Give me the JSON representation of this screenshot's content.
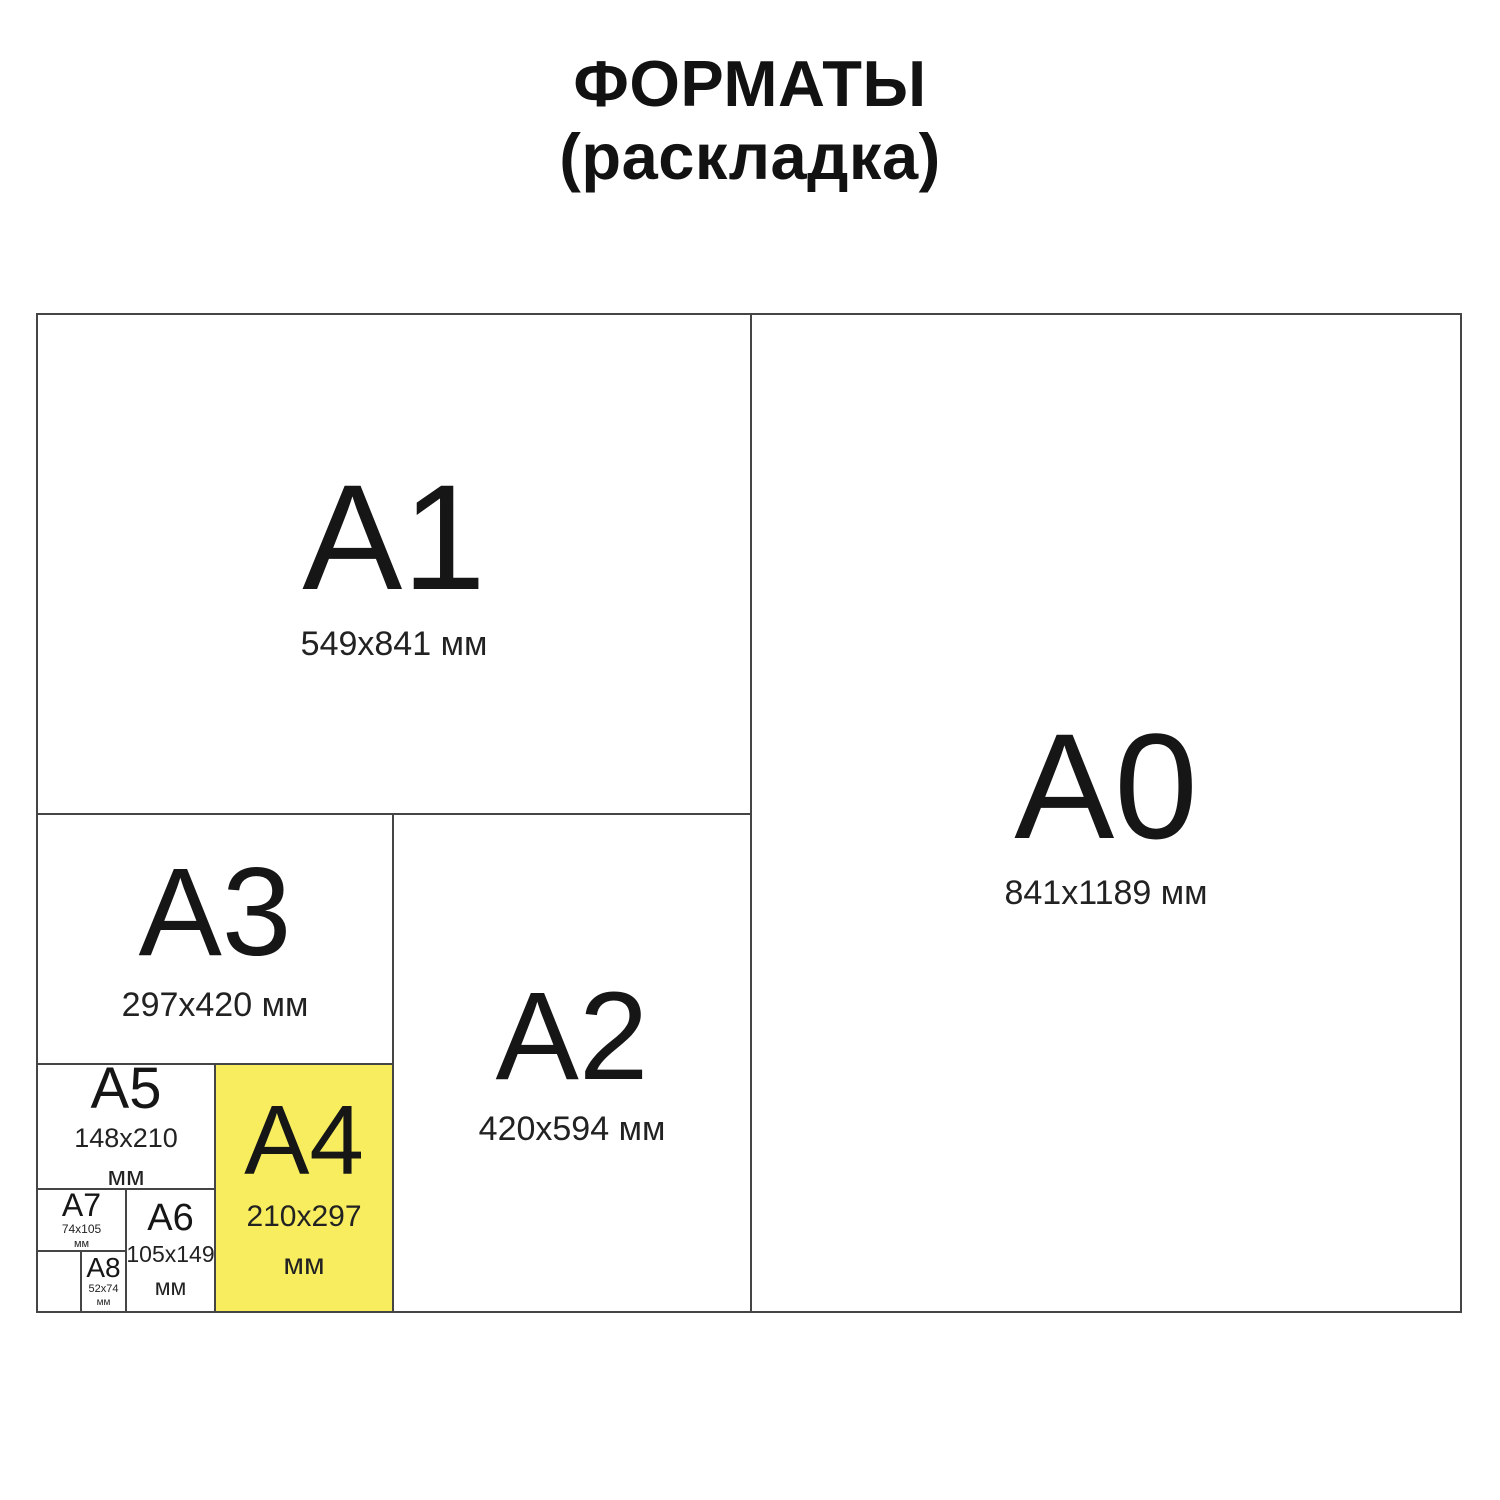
{
  "title": {
    "line1": "ФОРМАТЫ",
    "line2": "(раскладка)"
  },
  "colors": {
    "highlight": "#f7ed5e",
    "line": "#454545",
    "text": "#1c1c1c"
  },
  "formats": [
    {
      "label": "A1",
      "size": "549x841 мм"
    },
    {
      "label": "A0",
      "size": "841x1189 мм"
    },
    {
      "label": "A3",
      "size": "297x420 мм"
    },
    {
      "label": "A2",
      "size": "420x594 мм"
    },
    {
      "label": "A5",
      "size": "148x210",
      "unit": "мм"
    },
    {
      "label": "A4",
      "size": "210x297",
      "unit": "мм",
      "highlighted": true
    },
    {
      "label": "A7",
      "size": "74x105",
      "unit": "мм"
    },
    {
      "label": "A6",
      "size": "105x149",
      "unit": "мм"
    },
    {
      "label": "A8",
      "size": "52x74",
      "unit": "мм"
    }
  ]
}
